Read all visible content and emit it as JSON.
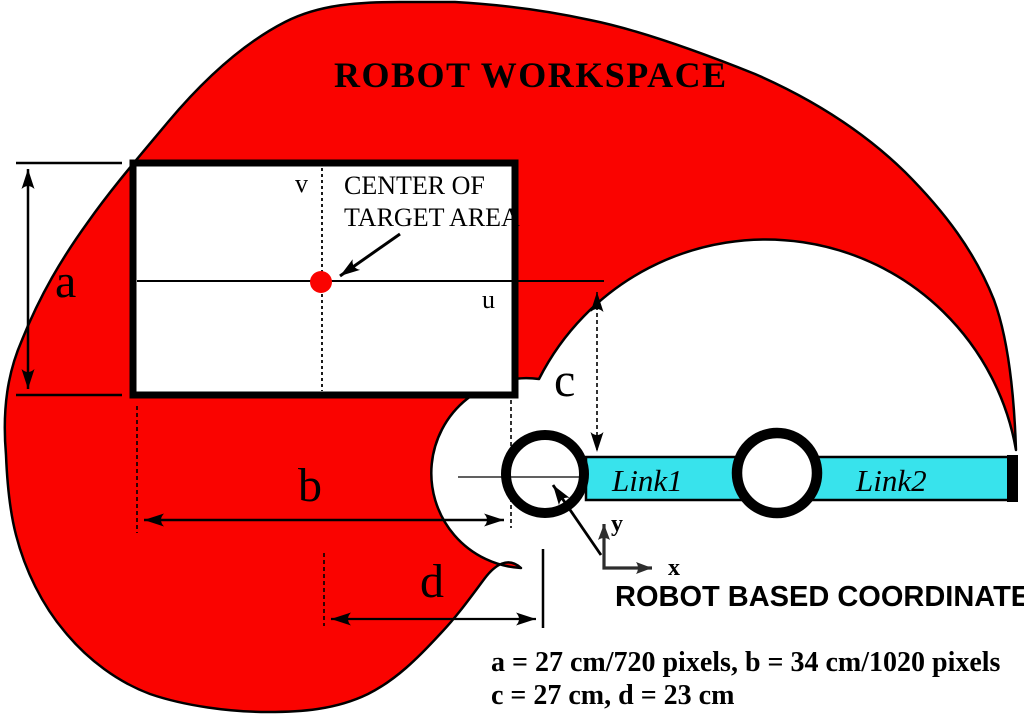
{
  "figure": {
    "title": "ROBOT WORKSPACE",
    "target_area": {
      "annotation_line1": "CENTER OF",
      "annotation_line2": "TARGET AREA",
      "v_label": "v",
      "u_label": "u"
    },
    "dimensions": {
      "a": "a",
      "b": "b",
      "c": "c",
      "d": "d"
    },
    "robot": {
      "link1": "Link1",
      "link2": "Link2",
      "coordinate_label": "ROBOT BASED COORDINATE",
      "x_label": "x",
      "y_label": "y"
    },
    "caption": {
      "line1": "a = 27 cm/720 pixels, b = 34 cm/1020 pixels",
      "line2": "c = 27 cm, d = 23 cm"
    },
    "colors": {
      "workspace": "#fa0300",
      "link": "#38e3ec",
      "center_dot": "#fa0300"
    }
  }
}
